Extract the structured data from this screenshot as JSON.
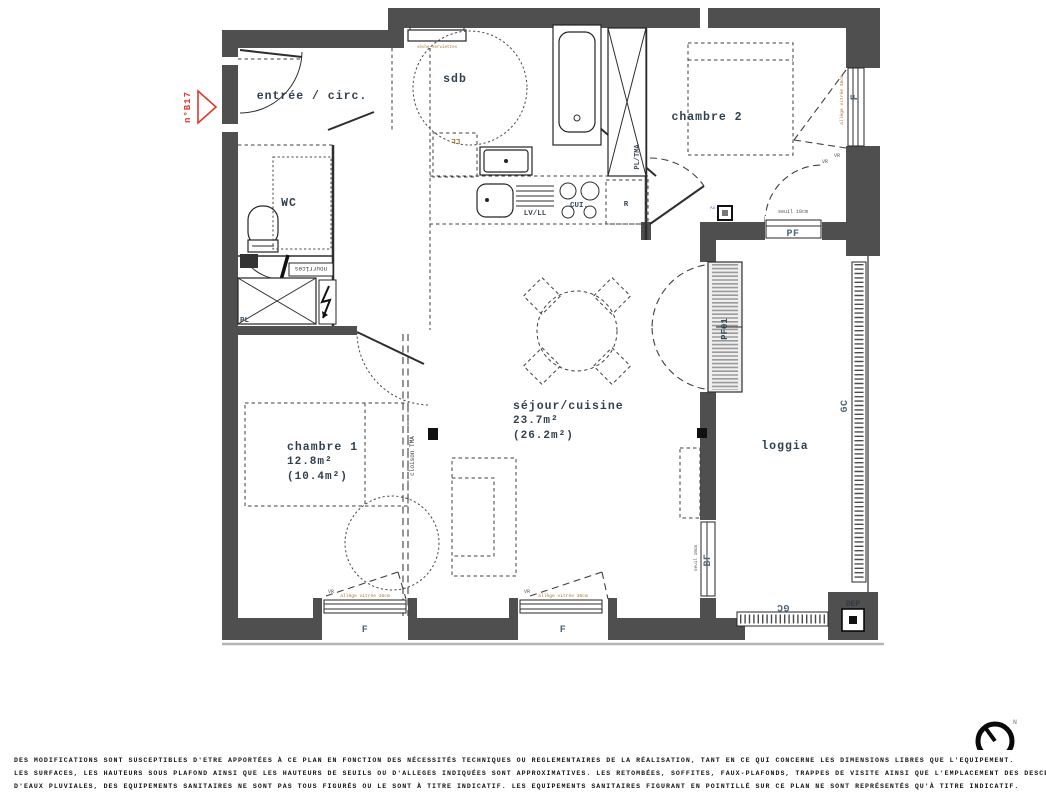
{
  "plan": {
    "unit": "n°B17",
    "rooms": {
      "entree": {
        "label": "entrée / circ."
      },
      "sdb": {
        "label": "sdb"
      },
      "wc": {
        "label": "WC"
      },
      "chambre2": {
        "label": "chambre 2"
      },
      "chambre1": {
        "label": "chambre 1",
        "area": "12.8m²",
        "area_alt": "(10.4m²)"
      },
      "sejour": {
        "label": "séjour/cuisine",
        "area": "23.7m²",
        "area_alt": "(26.2m²)"
      },
      "loggia": {
        "label": "loggia"
      }
    },
    "openings": {
      "window_f": "F",
      "porte_fenetre": "PF",
      "porte_fenetre_01": "PF01",
      "baie_fixe": "BF",
      "garde_corps": "GC",
      "descente_ep": "DEP"
    },
    "equipment": {
      "lave_linge": "LL",
      "lave_vaisselle": "LV/LL",
      "cuisson": "CUI.",
      "refrigerateur": "R",
      "placard": "PL",
      "placard_tma": "PL/TMA",
      "nourrices": "nourrices",
      "cloison": "cloison TMA",
      "seche_serviettes": "sèche-serviettes",
      "thermostat": "Aa"
    },
    "notes": {
      "seuil": "seuil 10cm",
      "allege": "allège vitrée 36cm",
      "volet_roulant": "VR"
    },
    "compass_north": "N"
  },
  "footer": {
    "line1": "DES MODIFICATIONS SONT SUSCEPTIBLES D'ETRE APPORTÉES À CE PLAN EN FONCTION DES NÉCESSITÉS TECHNIQUES OU REGLEMENTAIRES DE LA RÉALISATION, TANT EN CE QUI CONCERNE LES DIMENSIONS LIBRES QUE L'EQUIPEMENT.",
    "line2": "LES SURFACES, LES HAUTEURS SOUS PLAFOND AINSI QUE LES HAUTEURS DE SEUILS OU D'ALLEGES INDIQUÉES SONT APPROXIMATIVES. LES RETOMBÉES, SOFFITES, FAUX-PLAFONDS, TRAPPES DE VISITE AINSI QUE L'EMPLACEMENT DES DESCENTES",
    "line3": "D'EAUX PLUVIALES, DES EQUIPEMENTS SANITAIRES NE SONT PAS TOUS FIGURÉS OU LE SONT À TITRE INDICATIF. LES EQUIPEMENTS SANITAIRES FIGURANT EN POINTILLÉ SUR CE PLAN NE SONT REPRÉSENTÉS QU'À TITRE INDICATIF."
  }
}
